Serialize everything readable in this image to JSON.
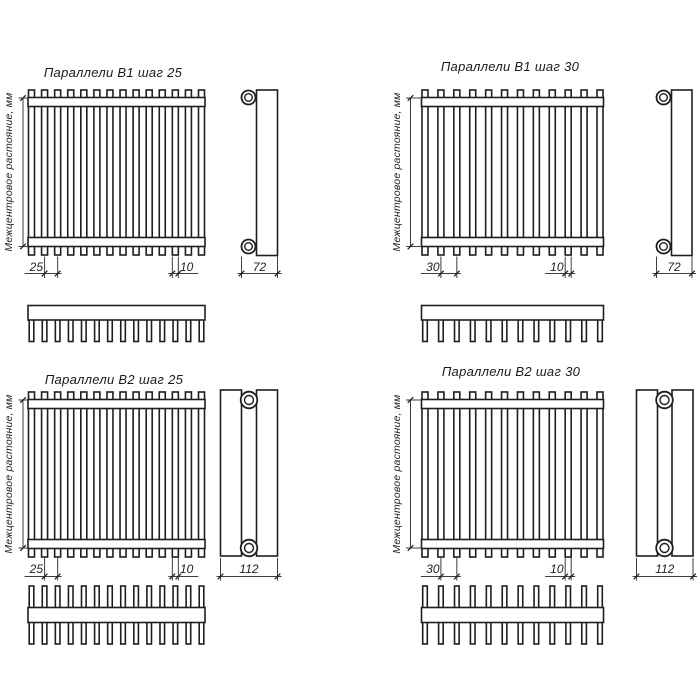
{
  "drawing": {
    "background": "#ffffff",
    "line_color": "#1e1e1e",
    "axis_label": "Межцентровое растояние, мм",
    "panels": [
      {
        "title": "Параллели В1 шаг 25",
        "tubes": 14,
        "rows": 1,
        "pitch_label": "25",
        "tube_width_label": "10",
        "depth_label": "72"
      },
      {
        "title": "Параллели В1 шаг 30",
        "tubes": 12,
        "rows": 1,
        "pitch_label": "30",
        "tube_width_label": "10",
        "depth_label": "72"
      },
      {
        "title": "Параллели В2 шаг 25",
        "tubes": 14,
        "rows": 2,
        "pitch_label": "25",
        "tube_width_label": "10",
        "depth_label": "112"
      },
      {
        "title": "Параллели В2 шаг 30",
        "tubes": 12,
        "rows": 2,
        "pitch_label": "30",
        "tube_width_label": "10",
        "depth_label": "112"
      }
    ]
  }
}
